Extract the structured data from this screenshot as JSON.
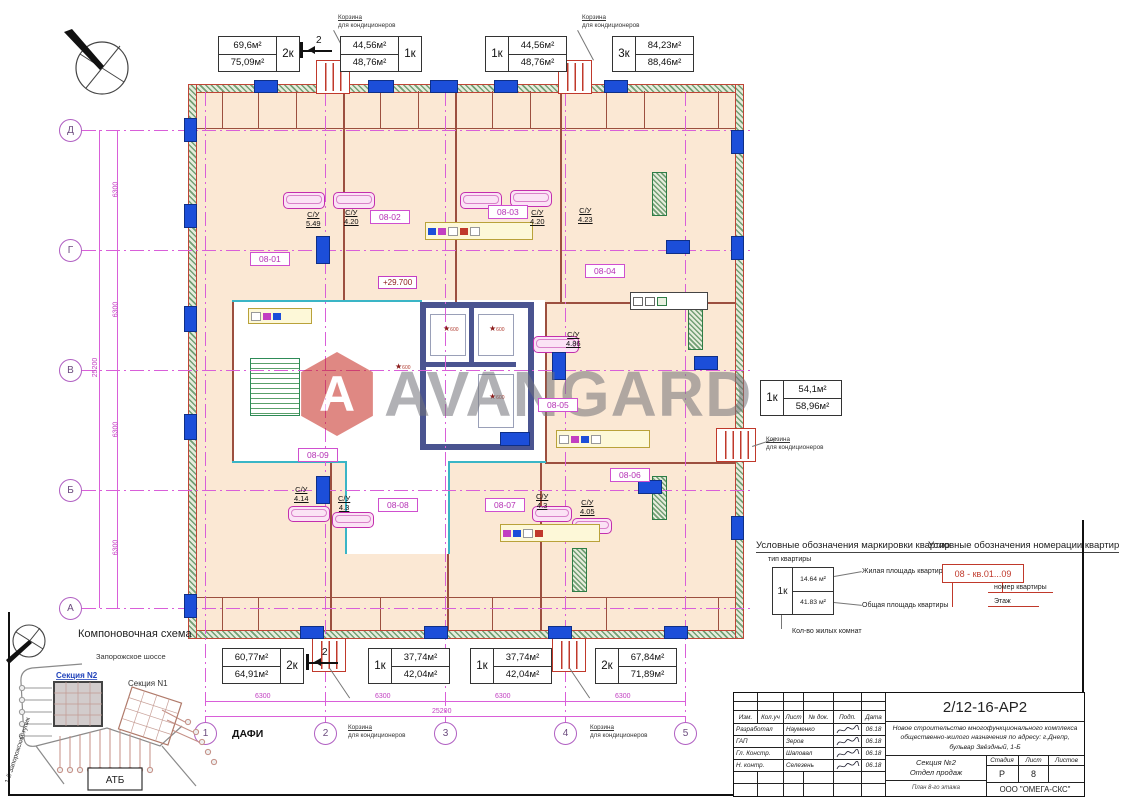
{
  "watermark": {
    "text": "AVANGARD",
    "logo_letter": "A",
    "logo_color": "#c5271e"
  },
  "apartments": {
    "top": [
      {
        "living": "69,6м²",
        "total": "75,09м²",
        "type": "2к"
      },
      {
        "living": "44,56м²",
        "total": "48,76м²",
        "type": "1к"
      },
      {
        "living": "44,56м²",
        "total": "48,76м²",
        "type": "1к"
      },
      {
        "living": "84,23м²",
        "total": "88,46м²",
        "type": "3к"
      }
    ],
    "right": {
      "living": "54,1м²",
      "total": "58,96м²",
      "type": "1к"
    },
    "bottom": [
      {
        "living": "60,77м²",
        "total": "64,91м²",
        "type": "2к"
      },
      {
        "living": "37,74м²",
        "total": "42,04м²",
        "type": "1к"
      },
      {
        "living": "37,74м²",
        "total": "42,04м²",
        "type": "1к"
      },
      {
        "living": "67,84м²",
        "total": "71,89м²",
        "type": "2к"
      }
    ]
  },
  "annotations": {
    "basket_line1": "Корзина",
    "basket_line2": "для кондиционеров",
    "section_mark": "2",
    "elevation": "+29.700",
    "dafi": "ДАФИ",
    "star_value": "600"
  },
  "room_tags": [
    "08-01",
    "08-02",
    "08-03",
    "08-04",
    "08-05",
    "08-06",
    "08-07",
    "08-08",
    "08-09"
  ],
  "wc": {
    "label": "С/У",
    "areas": [
      "5.49",
      "4.20",
      "4.20",
      "4.23",
      "4.86",
      "4.14",
      "4.3",
      "4.3",
      "4.05"
    ]
  },
  "axes": {
    "rows": [
      "Д",
      "Г",
      "В",
      "Б",
      "А"
    ],
    "cols": [
      "1",
      "2",
      "3",
      "4",
      "5"
    ],
    "dim": "6300",
    "total": "25200"
  },
  "legend_marking": {
    "title": "Условные обозначения маркировки квартир",
    "type_label": "тип квартиры",
    "sample_type": "1к",
    "living_value": "14.64 м²",
    "total_value": "41.83 м²",
    "living_label": "Жилая площадь квартиры",
    "total_label": "Общая площадь квартиры",
    "rooms_label": "Кол-во жилых комнат"
  },
  "legend_numbering": {
    "title": "Условные обозначения номерации квартир",
    "code": "08 - кв.01...09",
    "apt_label": "номер квартиры",
    "floor_label": "Этаж"
  },
  "site": {
    "title": "Компоновочная схема",
    "road_top": "Запорожское шоссе",
    "road_left": "1-й Запорожский тупик",
    "section2": "Секция N2",
    "section1": "Секция N1",
    "atb": "АТБ"
  },
  "title_block": {
    "doc_number": "2/12-16-АР2",
    "project_line1": "Новое строительство многофункционального комплекса",
    "project_line2": "общественно-жилого назначения по адресу: г.Днепр,",
    "project_line3": "бульвар Звёздный, 1-Б",
    "header": {
      "izm": "Изм.",
      "koluch": "Кол.уч",
      "list": "Лист",
      "ndok": "№ док.",
      "podp": "Подп.",
      "data": "Дата"
    },
    "rows": [
      {
        "role": "Разработал",
        "name": "Науменко",
        "date": "06.18"
      },
      {
        "role": "ГАП",
        "name": "Зеров",
        "date": "06.18"
      },
      {
        "role": "Гл. Констр.",
        "name": "Шаповал",
        "date": "06.18"
      },
      {
        "role": "Н. контр.",
        "name": "Селезень",
        "date": "06.18"
      }
    ],
    "section_line1": "Секция №2",
    "section_line2": "Отдел продаж",
    "stage_header": "Стадия",
    "sheet_header": "Лист",
    "sheets_header": "Листов",
    "stage": "Р",
    "sheet": "8",
    "sheets": "",
    "plan_caption": "План 8-го этажа",
    "company": "ООО \"ОМЕГА-СКС\""
  }
}
